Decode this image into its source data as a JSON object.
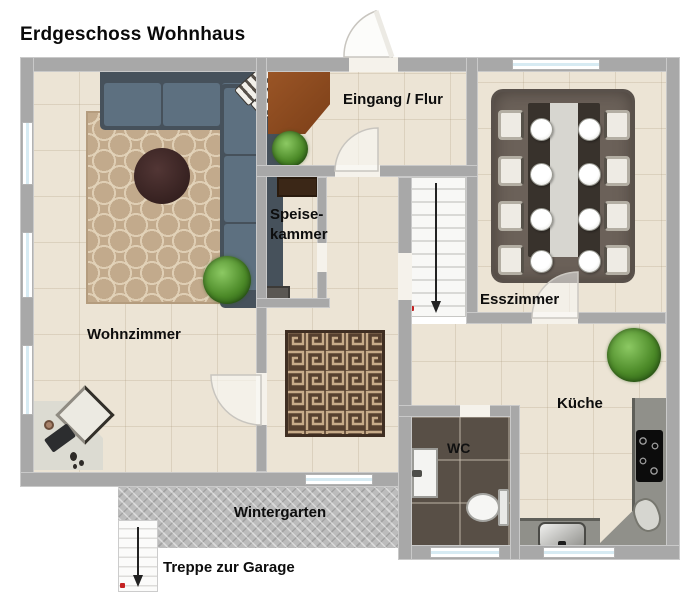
{
  "title": "Erdgeschoss Wohnhaus",
  "rooms": {
    "wohnzimmer": {
      "label": "Wohnzimmer"
    },
    "eingang_flur": {
      "label": "Eingang / Flur"
    },
    "speisekammer": {
      "label_line1": "Speise-",
      "label_line2": "kammer"
    },
    "esszimmer": {
      "label": "Esszimmer"
    },
    "kueche": {
      "label": "Küche"
    },
    "wc": {
      "label": "WC"
    },
    "wintergarten": {
      "label": "Wintergarten"
    },
    "treppe_zur_garage": {
      "label": "Treppe zur Garage"
    }
  },
  "icons": {
    "main_stairs_direction": "down-arrow",
    "garage_stairs_direction": "down-arrow",
    "stair_entry_marker": "red-dot"
  },
  "colors": {
    "wall": "#a8a8a8",
    "floor_tile": "#ece4d5",
    "sofa_seat": "#5d7080",
    "sofa_back": "#46515b",
    "living_rug": "#c2aa8c",
    "round_table": "#3a2423",
    "dining_rug": "#6b6159",
    "maze_rug": "#56402f",
    "wardrobe_wood": "#8a4c1f",
    "wc_floor": "#584f46",
    "wintergarten_floor": "#bcbcbc",
    "kitchen_counter": "#90908a",
    "plant_green": "#4c8a28",
    "window_glass": "#d7ebf3"
  },
  "furniture": [
    "corner-sofa",
    "living-room-rug",
    "round-side-table",
    "potted-plant-living",
    "desk",
    "desk-chair",
    "entry-wardrobe",
    "potted-plant-entry",
    "pantry-cabinet",
    "dining-table",
    "dining-chairs-x8",
    "dining-rug",
    "maze-pattern-rug",
    "main-staircase",
    "garage-staircase",
    "kitchen-counter",
    "cooktop",
    "kitchen-sink",
    "corner-sink",
    "potted-plant-kitchen",
    "wc-sink",
    "toilet"
  ]
}
